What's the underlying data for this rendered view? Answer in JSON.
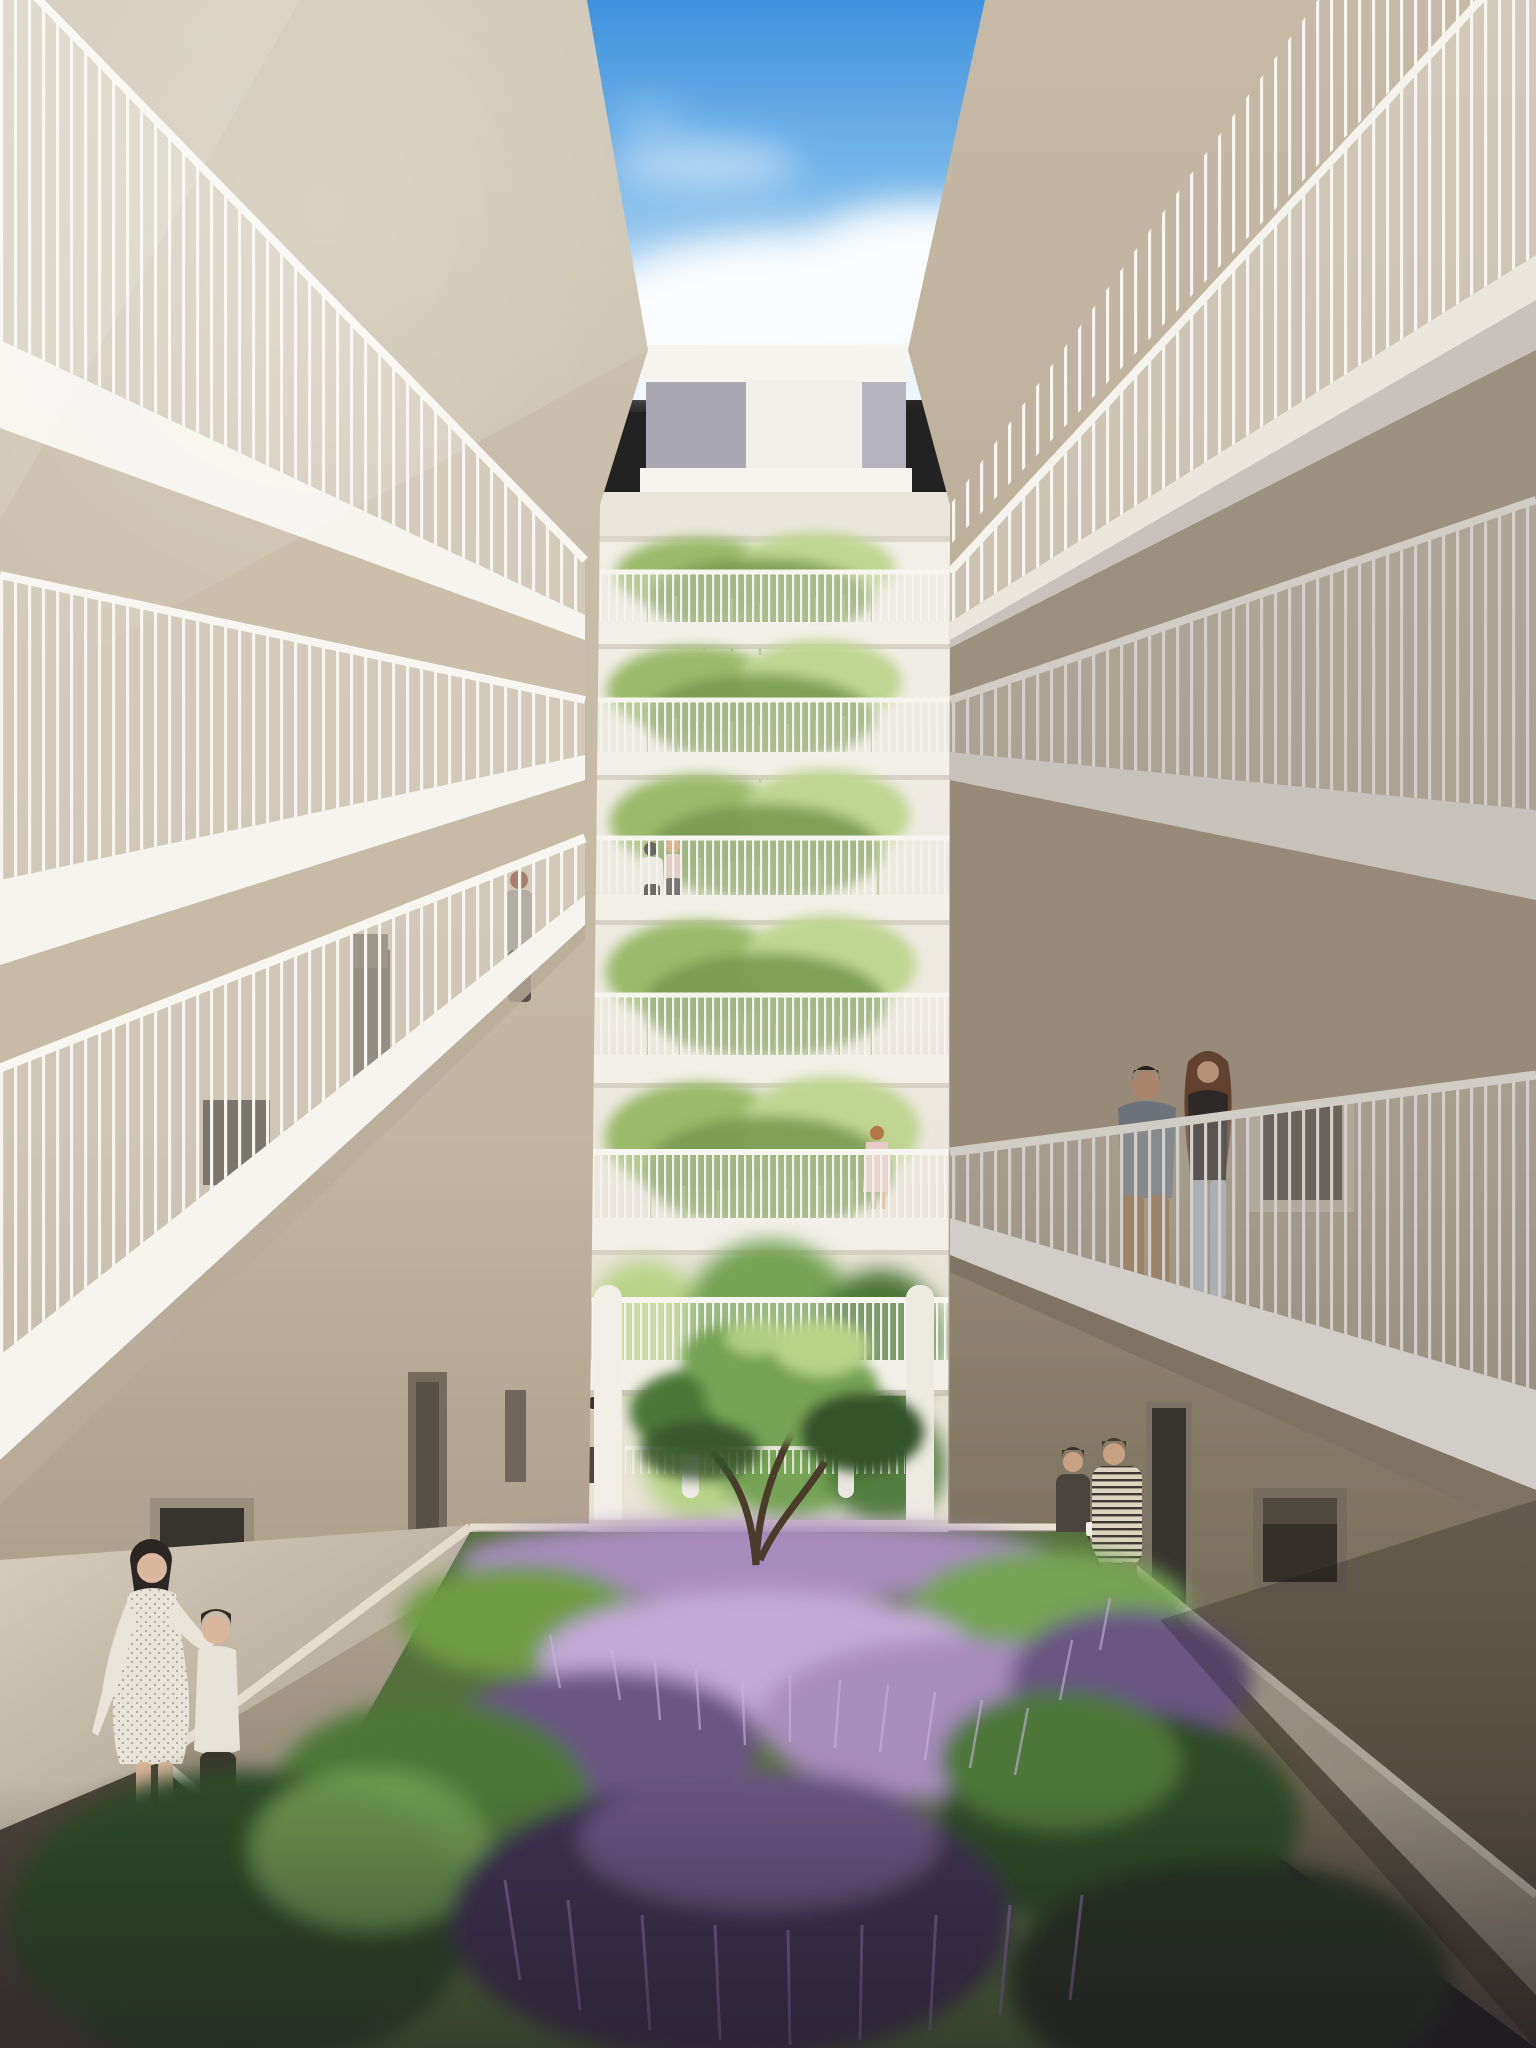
{
  "scene": {
    "title": "Courtyard atrium rendering",
    "description": "Architectural rendering of a tall residential courtyard atrium seen in one-point perspective. Beige gallery walkways with white vertical-baluster railings rise on both sides toward an open blue sky with cumulus clouds. The far wall stacks seven levels of balconies overflowing with hanging vines above a ground-floor passage. A planted courtyard of lavender and pine shrubs with a small multi-stem pine tree fills the foreground. Residents stand on walkways and beside the garden.",
    "style": "photorealistic CGI visualization",
    "time_of_day": "daytime"
  },
  "palette": {
    "sky_top": "#3E92DE",
    "sky_mid": "#79B7EA",
    "sky_low": "#C9E2F6",
    "cloud": "#FAFCFD",
    "white_bright": "#F6F4EF",
    "white_mid": "#EAE6DE",
    "white_soft": "#DDD7CC",
    "beige_light": "#D3C9B8",
    "beige_mid": "#C2B6A2",
    "beige_dark": "#A99D8A",
    "wall_shadow": "#8A8071",
    "wall_deep": "#6E6557",
    "panel_gray": "#A9A7B2",
    "panel_gray2": "#B6B4BE",
    "glass_dark": "#4A443C",
    "glass_deep": "#37332E",
    "vine_light": "#C0D592",
    "vine_mid": "#9CBA6C",
    "vine_dark": "#7A9A52",
    "tree_light": "#B9D389",
    "tree_mid": "#76A355",
    "tree_dark": "#4E7739",
    "tree_deep": "#35522C",
    "garden_green": "#6F9B45",
    "garden_green_dark": "#2F4A28",
    "lavender_light": "#C2A9D6",
    "lavender": "#A78CBE",
    "lavender_dark": "#6B5584",
    "lavender_deep": "#3E3350",
    "trunk": "#4A3B2B",
    "path_light": "#D6CDBD",
    "path_dark": "#A79D8C"
  },
  "architecture": {
    "levels_visible": 8,
    "vine_balcony_levels": 5,
    "railing_style": "white vertical balusters",
    "far_wall_features": [
      "rooftop bridge with gray panels",
      "stacked vine planters",
      "ground passage with round columns",
      "trees visible beyond passage"
    ],
    "side_features": [
      "gallery walkways",
      "recessed doors",
      "horizontal ribbon windows"
    ]
  },
  "garden": {
    "plants": [
      "lavender drifts",
      "pine shrub mounds",
      "multi-stem ornamental pine"
    ],
    "hardscape": [
      "white planter ledges",
      "perimeter walkways"
    ]
  },
  "people": [
    {
      "label": "woman looking up on left gallery",
      "x": 519,
      "y": 880,
      "hair": "#8A4F35",
      "skin": "#D8B092",
      "top": "#98938C",
      "bottom": "#57524C"
    },
    {
      "label": "resident in white shirt on far balcony",
      "x": 651,
      "y": 849,
      "hair": "#2C2825",
      "skin": "#D2A98A",
      "top": "#ECE8E2",
      "bottom": "#2E2B29"
    },
    {
      "label": "blonde resident on far balcony",
      "x": 673,
      "y": 846,
      "hair": "#C79B62",
      "skin": "#D8B092",
      "top": "#D9C2B8",
      "bottom": "#433D3A"
    },
    {
      "label": "woman in pale dress on lower far balcony",
      "x": 877,
      "y": 1133,
      "hair": "#B5764B",
      "skin": "#D8B092",
      "top": "#E7C9C5",
      "bottom": "#E7C9C5"
    },
    {
      "label": "man in gray tee at right railing",
      "x": 1146,
      "y": 1085,
      "hair": "#262220",
      "skin": "#C79B7D",
      "top": "#7A8591",
      "bottom": "#9C7A4E"
    },
    {
      "label": "woman with long hair at right railing",
      "x": 1208,
      "y": 1070,
      "hair": "#6E4A33",
      "skin": "#D4A98C",
      "top": "#2E2B2D",
      "bottom": "#B9C6D4"
    },
    {
      "label": "mother in polka-dot dress",
      "x": 150,
      "y": 1568,
      "hair": "#2A2623",
      "skin": "#D9B79C",
      "top": "#E9E4DA",
      "bottom": "#E9E4DA"
    },
    {
      "label": "child in white shirt",
      "x": 216,
      "y": 1630,
      "hair": "#332C26",
      "skin": "#D9B79C",
      "top": "#E8E3D8",
      "bottom": "#3A352F"
    },
    {
      "label": "woman with mug near right doorway",
      "x": 1073,
      "y": 1462,
      "hair": "#3A332C",
      "skin": "#C9A183",
      "top": "#4A443E",
      "bottom": "#35302B",
      "accent": "#F2EFE8"
    },
    {
      "label": "man in striped shirt near right doorway",
      "x": 1114,
      "y": 1454,
      "hair": "#473C32",
      "skin": "#C9A183",
      "top": "#D9D2C2",
      "bottom": "#8D7F5E"
    },
    {
      "label": "man walking in far passage",
      "x": 593,
      "y": 1403,
      "hair": "#3B332B",
      "skin": "#C9A183",
      "top": "#CFC4AE",
      "bottom": "#4E463E"
    }
  ],
  "sky": {
    "clouds": true,
    "description": "blue sky with sunlit cumulus clouds at the atrium opening"
  }
}
